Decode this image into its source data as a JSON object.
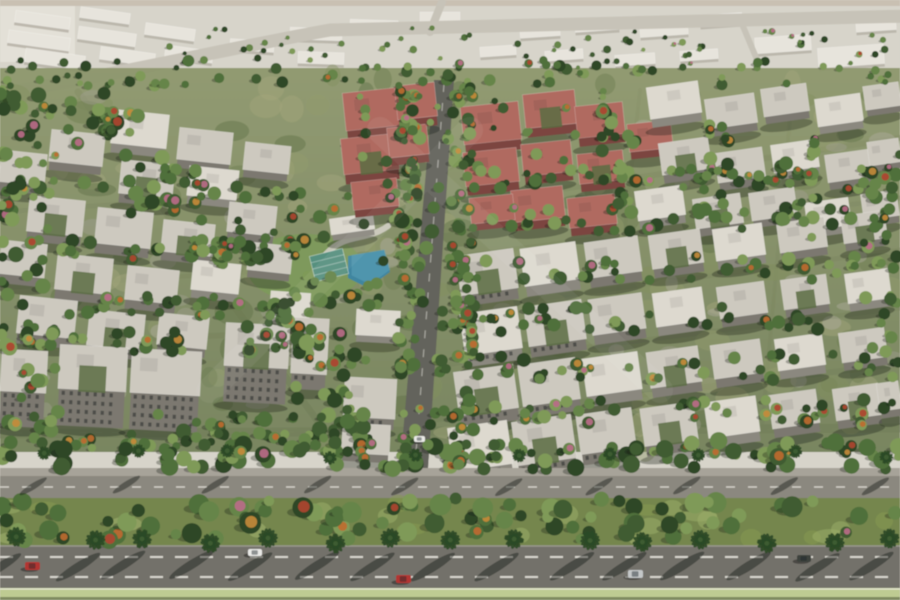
{
  "meta": {
    "description": "Aerial 3D architectural rendering of a residential apartment compound with tree-lined streets, central avenue, swimming pool area and a palm-lined boulevard in the foreground",
    "render_type": "architectural-aerial-render"
  },
  "palette": {
    "topStrip": "#c9c0b2",
    "distantBg": "#d7d4ca",
    "distantHaze": "#e5e2d9",
    "distantRoad": "#c7c3b8",
    "groundTop": "#8a9468",
    "groundBottom": "#6f7d55",
    "mottleGreens": [
      "#5f7046",
      "#6d7c50",
      "#82905f",
      "#939c6c",
      "#a3a67c"
    ],
    "mottlePaved": [
      "#a39f93",
      "#b4b0a4"
    ],
    "roadMid": "#8a8780",
    "roadEdge": "#9b988e",
    "asphalt": "#63635c",
    "dash": "#e9e7df",
    "roofs": [
      "#cdc9bf",
      "#ddd9cf",
      "#b06b61",
      "#e7e4dc"
    ],
    "facades": [
      "#7b786f",
      "#8b887f",
      "#7c453f",
      "#b8b4a9"
    ],
    "notch": "#5b6c42",
    "treeGreens": [
      "#2f4627",
      "#3f5c31",
      "#4f6f3b",
      "#66854a",
      "#7f9a58"
    ],
    "treeAccents": [
      "#c06a30",
      "#b04430",
      "#c78b3a",
      "#bb6b8a"
    ],
    "palm": "#2c4a26",
    "palmLight": "#3d5c30",
    "pool": "#3f86a0",
    "poolLight": "#66a8bd",
    "deck": "#cfccc2",
    "lawn": "#7d9a5a",
    "tealRoof": "#57907f",
    "walk": "#a7a399",
    "road1": "#8b887f",
    "median": "#75864e",
    "strip": "#becb92",
    "stripDark": "#7f8a60",
    "road2": "#73716a",
    "curb": "#9a978e",
    "carColors": {
      "red": "#b23430",
      "white": "#e9e9e6",
      "silver": "#c4c7c8",
      "dark": "#3d423c"
    }
  },
  "scene": {
    "seed": 7,
    "width": 900,
    "height": 600,
    "distantBuildings": [
      [
        15,
        14,
        55,
        12,
        8
      ],
      [
        80,
        10,
        50,
        11,
        8
      ],
      [
        8,
        34,
        62,
        13,
        8
      ],
      [
        78,
        30,
        58,
        13,
        8
      ],
      [
        145,
        26,
        50,
        12,
        8
      ],
      [
        25,
        52,
        60,
        14,
        8
      ],
      [
        100,
        50,
        55,
        13,
        8
      ],
      [
        165,
        48,
        48,
        12,
        8
      ],
      [
        230,
        40,
        44,
        11,
        4
      ],
      [
        290,
        28,
        52,
        12,
        2
      ],
      [
        350,
        20,
        48,
        11,
        2
      ],
      [
        298,
        52,
        46,
        12,
        2
      ],
      [
        420,
        12,
        40,
        10,
        0
      ],
      [
        480,
        46,
        36,
        10,
        -4
      ],
      [
        520,
        26,
        40,
        11,
        -4
      ],
      [
        545,
        50,
        38,
        10,
        -4
      ],
      [
        575,
        20,
        44,
        11,
        -4
      ],
      [
        615,
        54,
        40,
        11,
        -4
      ],
      [
        640,
        24,
        48,
        12,
        -4
      ],
      [
        680,
        50,
        38,
        10,
        -4
      ],
      [
        700,
        14,
        42,
        11,
        -4
      ],
      [
        755,
        36,
        56,
        16,
        -4
      ],
      [
        818,
        46,
        66,
        20,
        -4
      ],
      [
        856,
        20,
        40,
        11,
        -4
      ]
    ],
    "buildings": [
      [
        112,
        112,
        56,
        34,
        6,
        1,
        0
      ],
      [
        178,
        130,
        54,
        32,
        6,
        0,
        0
      ],
      [
        50,
        132,
        54,
        32,
        6,
        0,
        0
      ],
      [
        0,
        152,
        46,
        32,
        6,
        0,
        0
      ],
      [
        120,
        162,
        54,
        34,
        6,
        0,
        1
      ],
      [
        188,
        168,
        50,
        30,
        6,
        1,
        0
      ],
      [
        244,
        144,
        46,
        28,
        6,
        0,
        0
      ],
      [
        28,
        198,
        56,
        36,
        6,
        0,
        1
      ],
      [
        96,
        210,
        56,
        36,
        6,
        0,
        0
      ],
      [
        162,
        222,
        52,
        32,
        6,
        0,
        1
      ],
      [
        228,
        204,
        48,
        30,
        6,
        0,
        0
      ],
      [
        0,
        242,
        46,
        34,
        6,
        0,
        0
      ],
      [
        56,
        256,
        56,
        36,
        6,
        0,
        1
      ],
      [
        126,
        268,
        52,
        34,
        6,
        0,
        0
      ],
      [
        192,
        262,
        48,
        30,
        6,
        1,
        0
      ],
      [
        248,
        244,
        44,
        28,
        6,
        0,
        0
      ],
      [
        18,
        298,
        58,
        38,
        6,
        0,
        0
      ],
      [
        88,
        312,
        56,
        36,
        6,
        0,
        1
      ],
      [
        158,
        315,
        50,
        32,
        6,
        0,
        0
      ],
      [
        270,
        292,
        40,
        26,
        4,
        1,
        0
      ],
      [
        356,
        310,
        44,
        26,
        3,
        1,
        0
      ],
      [
        0,
        350,
        46,
        78,
        3,
        0,
        0
      ],
      [
        58,
        346,
        68,
        82,
        3,
        0,
        1
      ],
      [
        130,
        350,
        70,
        82,
        3,
        0,
        0
      ],
      [
        224,
        324,
        64,
        80,
        3,
        0,
        1
      ],
      [
        292,
        318,
        36,
        56,
        3,
        0,
        0
      ],
      [
        344,
        378,
        52,
        40,
        3,
        0,
        0
      ],
      [
        342,
        424,
        48,
        30,
        3,
        0,
        0
      ],
      [
        330,
        216,
        44,
        16,
        -8,
        1,
        0
      ],
      [
        344,
        90,
        60,
        38,
        -6,
        2,
        0
      ],
      [
        396,
        84,
        40,
        34,
        -6,
        2,
        0
      ],
      [
        342,
        136,
        56,
        36,
        -6,
        2,
        1
      ],
      [
        388,
        126,
        40,
        30,
        -6,
        2,
        0
      ],
      [
        462,
        104,
        58,
        38,
        -6,
        2,
        0
      ],
      [
        524,
        92,
        52,
        34,
        -6,
        2,
        1
      ],
      [
        464,
        150,
        54,
        34,
        -6,
        2,
        0
      ],
      [
        522,
        142,
        50,
        32,
        -6,
        2,
        0
      ],
      [
        576,
        104,
        48,
        32,
        -6,
        2,
        0
      ],
      [
        578,
        152,
        46,
        30,
        -6,
        2,
        1
      ],
      [
        628,
        122,
        44,
        28,
        -6,
        2,
        0
      ],
      [
        512,
        188,
        52,
        32,
        -6,
        2,
        0
      ],
      [
        568,
        196,
        48,
        30,
        -6,
        2,
        0
      ],
      [
        470,
        196,
        44,
        26,
        -6,
        2,
        0
      ],
      [
        352,
        180,
        46,
        28,
        -6,
        2,
        0
      ],
      [
        648,
        84,
        52,
        32,
        -8,
        1,
        0
      ],
      [
        706,
        96,
        50,
        30,
        -8,
        0,
        0
      ],
      [
        762,
        86,
        46,
        28,
        -8,
        0,
        0
      ],
      [
        816,
        96,
        46,
        28,
        -8,
        1,
        0
      ],
      [
        864,
        84,
        36,
        24,
        -8,
        0,
        0
      ],
      [
        660,
        140,
        50,
        32,
        -8,
        0,
        1
      ],
      [
        716,
        150,
        48,
        30,
        -8,
        0,
        0
      ],
      [
        772,
        142,
        46,
        28,
        -8,
        1,
        0
      ],
      [
        826,
        152,
        44,
        28,
        -8,
        0,
        0
      ],
      [
        868,
        140,
        32,
        24,
        -8,
        0,
        0
      ],
      [
        636,
        188,
        48,
        30,
        -8,
        1,
        0
      ],
      [
        694,
        196,
        48,
        30,
        -8,
        0,
        1
      ],
      [
        750,
        190,
        46,
        28,
        -8,
        0,
        0
      ],
      [
        806,
        200,
        44,
        28,
        -8,
        1,
        0
      ],
      [
        862,
        192,
        36,
        26,
        -8,
        0,
        0
      ],
      [
        458,
        252,
        58,
        40,
        -8,
        0,
        1
      ],
      [
        522,
        245,
        56,
        38,
        -8,
        1,
        0
      ],
      [
        586,
        239,
        54,
        36,
        -8,
        0,
        0
      ],
      [
        650,
        232,
        52,
        34,
        -8,
        0,
        1
      ],
      [
        714,
        226,
        50,
        32,
        -8,
        1,
        0
      ],
      [
        778,
        220,
        48,
        30,
        -8,
        0,
        0
      ],
      [
        842,
        213,
        44,
        28,
        -8,
        0,
        1
      ],
      [
        462,
        310,
        58,
        42,
        -8,
        1,
        0
      ],
      [
        526,
        303,
        58,
        40,
        -8,
        0,
        1
      ],
      [
        590,
        296,
        54,
        36,
        -8,
        0,
        0
      ],
      [
        654,
        290,
        50,
        34,
        -8,
        1,
        0
      ],
      [
        718,
        284,
        48,
        32,
        -8,
        0,
        0
      ],
      [
        782,
        277,
        46,
        30,
        -8,
        0,
        1
      ],
      [
        846,
        271,
        44,
        30,
        -8,
        1,
        0
      ],
      [
        456,
        368,
        60,
        44,
        -8,
        0,
        1
      ],
      [
        520,
        361,
        58,
        42,
        -8,
        0,
        0
      ],
      [
        584,
        355,
        56,
        38,
        -8,
        1,
        0
      ],
      [
        648,
        349,
        52,
        36,
        -8,
        0,
        1
      ],
      [
        712,
        342,
        50,
        34,
        -8,
        0,
        0
      ],
      [
        776,
        336,
        48,
        32,
        -8,
        1,
        0
      ],
      [
        840,
        330,
        46,
        30,
        -8,
        0,
        0
      ],
      [
        450,
        424,
        60,
        44,
        -8,
        1,
        0
      ],
      [
        514,
        418,
        60,
        44,
        -8,
        0,
        1
      ],
      [
        578,
        411,
        56,
        40,
        -8,
        0,
        0
      ],
      [
        642,
        405,
        54,
        38,
        -8,
        0,
        1
      ],
      [
        706,
        399,
        52,
        36,
        -8,
        1,
        0
      ],
      [
        770,
        392,
        48,
        34,
        -8,
        0,
        0
      ],
      [
        834,
        386,
        46,
        32,
        -8,
        0,
        1
      ],
      [
        878,
        382,
        22,
        28,
        -8,
        0,
        0
      ]
    ],
    "roads": [
      {
        "d": "M -10 96 C 150 68 240 46 330 30 L 910 16",
        "w": 13,
        "c": "distantRoad",
        "o": 1
      },
      {
        "d": "M 430 32 L 442 2",
        "w": 8,
        "c": "distantRoad",
        "o": 1
      },
      {
        "d": "M 742 24 L 758 62",
        "w": 6,
        "c": "distantRoad",
        "o": 1
      },
      {
        "d": "M 78 92 L 335 445",
        "w": 7,
        "c": "roadMid",
        "o": 0.8
      },
      {
        "d": "M 0 212 L 250 196",
        "w": 5,
        "c": "roadMid",
        "o": 0.6
      },
      {
        "d": "M 0 288 L 310 268",
        "w": 5,
        "c": "roadMid",
        "o": 0.6
      },
      {
        "d": "M 0 345 L 345 330",
        "w": 6,
        "c": "roadMid",
        "o": 0.7
      },
      {
        "d": "M 455 205 L 900 138",
        "w": 6,
        "c": "roadMid",
        "o": 0.65
      },
      {
        "d": "M 448 258 L 900 198",
        "w": 5,
        "c": "roadMid",
        "o": 0.6
      },
      {
        "d": "M 442 312 L 900 250",
        "w": 5,
        "c": "roadMid",
        "o": 0.6
      },
      {
        "d": "M 436 366 L 900 308",
        "w": 5,
        "c": "roadMid",
        "o": 0.6
      },
      {
        "d": "M 430 420 L 900 364",
        "w": 6,
        "c": "roadMid",
        "o": 0.65
      },
      {
        "d": "M 640 90 L 602 438",
        "w": 4,
        "c": "roadMid",
        "o": 0.45
      },
      {
        "d": "M 792 96 L 762 428",
        "w": 4,
        "c": "roadMid",
        "o": 0.45
      },
      {
        "d": "M 0 434 L 900 428",
        "w": 9,
        "c": "roadEdge",
        "o": 1
      }
    ],
    "avenue": {
      "points": "434,80 454,80 428,468 400,468",
      "dash": "M 444 84 L 415 466"
    },
    "pool": {
      "lawn": {
        "cx": 305,
        "cy": 268,
        "rx": 58,
        "ry": 34
      },
      "deckPath": "M 326 254 C 346 232 366 242 388 226",
      "mainPool": "M 348 256 L 384 250 L 390 272 L 368 288 L 348 278 Z",
      "pond": {
        "cx": 399,
        "cy": 151,
        "rx": 10,
        "ry": 5,
        "rot": -14
      },
      "clubhouse": {
        "x": 312,
        "y": 252,
        "w": 34,
        "h": 26,
        "rot": -14
      }
    },
    "treeClusters": [
      [
        150,
        28,
        740,
        40,
        70,
        0.04,
        2,
        4
      ],
      [
        0,
        60,
        900,
        26,
        80,
        0.06,
        3,
        6
      ],
      [
        0,
        85,
        58,
        360,
        70,
        0.12,
        4,
        8
      ],
      [
        60,
        92,
        90,
        60,
        22,
        0.2,
        4,
        8
      ],
      [
        125,
        155,
        90,
        62,
        22,
        0.2,
        4,
        8
      ],
      [
        190,
        220,
        85,
        62,
        22,
        0.22,
        4,
        8
      ],
      [
        245,
        285,
        85,
        64,
        22,
        0.22,
        4,
        8
      ],
      [
        295,
        348,
        75,
        66,
        20,
        0.22,
        4,
        8
      ],
      [
        315,
        408,
        60,
        56,
        16,
        0.2,
        4,
        8
      ],
      [
        398,
        84,
        22,
        384,
        70,
        0.3,
        4,
        7
      ],
      [
        452,
        84,
        22,
        384,
        70,
        0.3,
        4,
        7
      ],
      [
        285,
        205,
        150,
        108,
        40,
        0.15,
        4,
        8
      ],
      [
        0,
        178,
        310,
        20,
        28,
        0.15,
        4,
        7
      ],
      [
        0,
        240,
        310,
        20,
        28,
        0.15,
        4,
        7
      ],
      [
        55,
        296,
        260,
        20,
        26,
        0.15,
        4,
        7
      ],
      [
        0,
        332,
        340,
        22,
        32,
        0.2,
        4,
        8
      ],
      [
        150,
        412,
        215,
        28,
        28,
        0.2,
        4,
        8
      ],
      [
        0,
        432,
        350,
        18,
        24,
        0.15,
        4,
        7
      ],
      [
        335,
        85,
        290,
        118,
        44,
        0.12,
        3,
        6
      ],
      [
        470,
        168,
        430,
        22,
        38,
        0.2,
        4,
        7
      ],
      [
        455,
        208,
        445,
        24,
        40,
        0.2,
        4,
        7
      ],
      [
        448,
        256,
        452,
        24,
        40,
        0.18,
        4,
        7
      ],
      [
        442,
        306,
        458,
        26,
        42,
        0.22,
        4,
        7
      ],
      [
        436,
        354,
        464,
        26,
        42,
        0.22,
        4,
        7
      ],
      [
        430,
        400,
        470,
        26,
        42,
        0.2,
        4,
        7
      ],
      [
        428,
        444,
        472,
        16,
        26,
        0.15,
        4,
        6
      ],
      [
        598,
        95,
        38,
        110,
        22,
        0.15,
        4,
        7
      ],
      [
        692,
        118,
        38,
        100,
        18,
        0.15,
        4,
        7
      ],
      [
        780,
        138,
        38,
        105,
        18,
        0.15,
        4,
        7
      ],
      [
        862,
        150,
        38,
        256,
        30,
        0.15,
        4,
        7
      ],
      [
        0,
        440,
        900,
        30,
        95,
        0.1,
        5,
        9
      ],
      [
        0,
        498,
        900,
        42,
        85,
        0.18,
        5,
        11
      ]
    ],
    "boulevard": {
      "walk": {
        "y": 468,
        "h": 8
      },
      "road1": {
        "y": 476,
        "h": 22,
        "dashY": 487
      },
      "median": {
        "y": 498,
        "h": 48
      },
      "road2": {
        "y": 546,
        "h": 42,
        "dashY1": 557,
        "dashY2": 577
      },
      "strip": {
        "y": 588,
        "h": 9,
        "lineY": 589
      },
      "footer": {
        "y": 597,
        "h": 3
      },
      "palmRow1": {
        "y": 454,
        "step": 95,
        "r": 7,
        "shadowY": 486,
        "shadowLen": 16
      },
      "palmRow2": {
        "y": 540,
        "step": 62,
        "r": 10,
        "shadowY": 566,
        "shadowLen": 26
      }
    },
    "cars": [
      [
        25,
        562,
        15,
        8,
        "red"
      ],
      [
        248,
        549,
        14,
        7,
        "white"
      ],
      [
        628,
        570,
        15,
        8,
        "silver"
      ],
      [
        797,
        555,
        14,
        7,
        "dark"
      ],
      [
        396,
        575,
        15,
        8,
        "red"
      ],
      [
        414,
        436,
        11,
        6,
        "white"
      ]
    ],
    "watermark": [
      "M 210 390 L 470 130",
      "M 380 130 L 660 390"
    ]
  }
}
